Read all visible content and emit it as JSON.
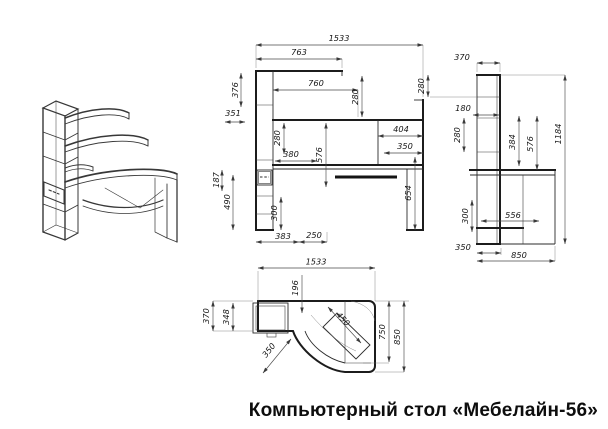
{
  "title": "Компьютерный стол «Мебелайн-56»",
  "views": {
    "front": {
      "dims": {
        "total_width": "1533",
        "shelf_top_width": "763",
        "top_height": "376",
        "left_gap": "351",
        "shelf_mid_width": "760",
        "right_top_height": "280",
        "inner_height": "280",
        "niche_width": "404",
        "right_width": "350",
        "shelf_low_width": "380",
        "desk_height": "576",
        "drawer_height": "187",
        "left_lower_height": "490",
        "lower_height": "300",
        "right_lower_height": "654",
        "bottom_left_width": "383",
        "bottom_mid_width": "250"
      }
    },
    "side": {
      "dims": {
        "top_depth": "370",
        "upper_height": "280",
        "inner_width": "180",
        "inner_height": "280",
        "mid_height": "384",
        "total_height": "1184",
        "desk_height": "576",
        "lower_height": "300",
        "tray_depth": "556",
        "foot_depth": "350",
        "total_depth": "850"
      }
    },
    "top": {
      "dims": {
        "total_width": "1533",
        "left_depth": "370",
        "left_inner_depth": "348",
        "tray_offset": "196",
        "corner_diag": "450",
        "tray_diag": "350",
        "right_inner_depth": "750",
        "right_depth": "850"
      }
    }
  }
}
